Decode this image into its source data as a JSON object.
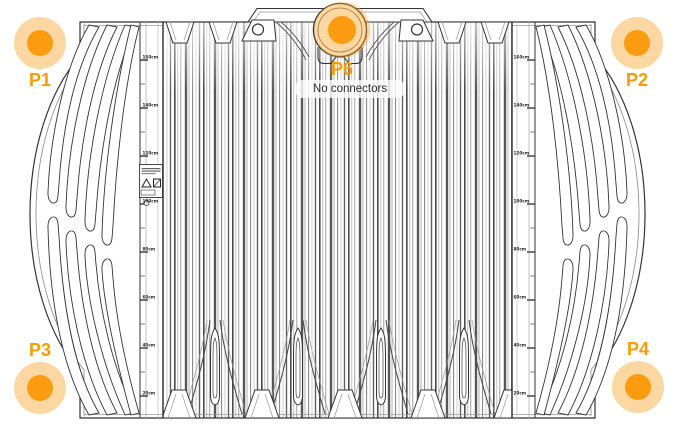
{
  "view": {
    "description": "Tank side elevation technical drawing with connector port markers",
    "background": "#ffffff"
  },
  "markers": [
    {
      "id": "P1",
      "label": "P1",
      "position": "top-left"
    },
    {
      "id": "P2",
      "label": "P2",
      "position": "top-right"
    },
    {
      "id": "P3",
      "label": "P3",
      "position": "bottom-left"
    },
    {
      "id": "P4",
      "label": "P4",
      "position": "bottom-right"
    },
    {
      "id": "P6",
      "label": "P6",
      "position": "top-center"
    }
  ],
  "tooltip": {
    "text": "No connectors",
    "attached_to": "P6"
  },
  "gauge": {
    "labels": [
      "160cm",
      "140cm",
      "120cm",
      "100cm",
      "80cm",
      "60cm",
      "40cm",
      "20cm"
    ]
  },
  "label_plate": {
    "icons": [
      "warning-triangle-icon",
      "prohibition-icon"
    ]
  },
  "colors": {
    "marker_dot": "#fb9b10",
    "marker_halo": "rgba(250,160,30,0.42)",
    "marker_label": "#f89b05",
    "tooltip_bg": "rgba(255,255,255,0.8)",
    "tooltip_text": "#2b2b2b",
    "line_dark": "#333333",
    "line_light": "#999999"
  }
}
